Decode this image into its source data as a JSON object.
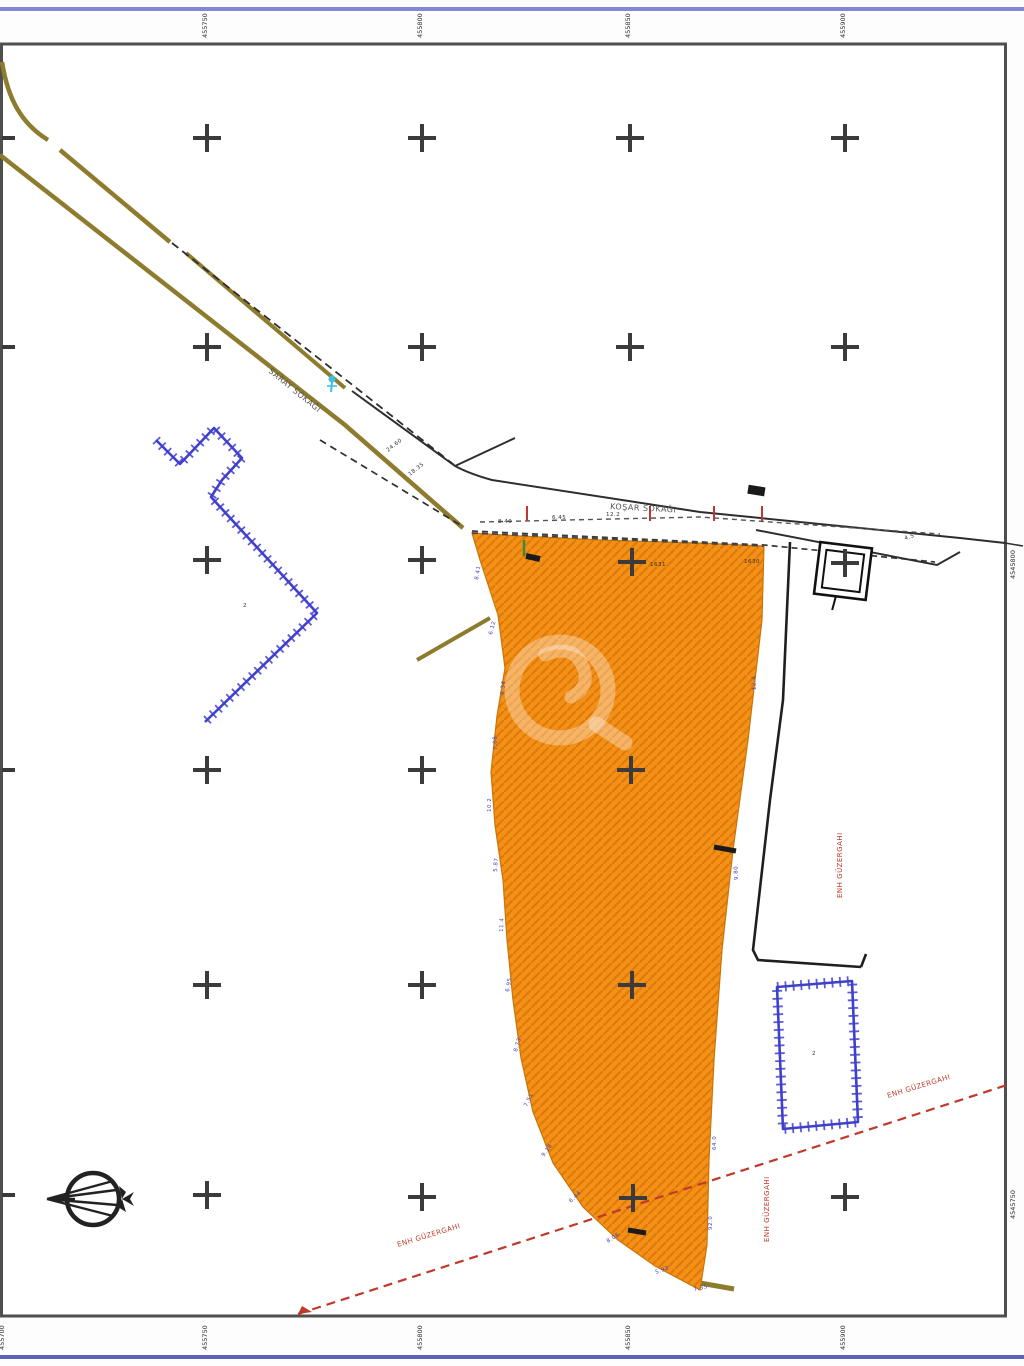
{
  "map": {
    "sheet": {
      "accent_top_color": "#8287d8",
      "accent_bottom_color": "#5b63c0",
      "frame_color": "#4f4f4f",
      "parcel_fill": "#f39018",
      "parcel_hatch": "#e07a06",
      "road_color": "#8d7b2e",
      "line_color": "#2e2e2e",
      "embankment_color": "#4040cc",
      "route_color": "#c0392b",
      "cross_color": "#3b3b3b",
      "marker_cyan": "#3fc0e0",
      "marker_green": "#3a8a3a"
    },
    "road_labels": [
      {
        "x": 268,
        "y": 372,
        "rot": 39,
        "text": "SARAY SOKAĞI"
      },
      {
        "x": 610,
        "y": 509,
        "rot": 3,
        "text": "KOŞAR SOKAĞI"
      }
    ],
    "red_labels": [
      {
        "x": 398,
        "y": 1247,
        "rot": -17,
        "text": "ENH GÜZERGAHI"
      },
      {
        "x": 888,
        "y": 1098,
        "rot": -17,
        "text": "ENH GÜZERGAHI"
      },
      {
        "x": 842,
        "y": 898,
        "rot": -90,
        "text": "ENH GÜZERGAHI"
      },
      {
        "x": 769,
        "y": 1242,
        "rot": -90,
        "text": "ENH GÜZERGAHI"
      }
    ],
    "grid_crosses": [
      [
        207,
        138
      ],
      [
        422,
        138
      ],
      [
        630,
        138
      ],
      [
        845,
        138
      ],
      [
        207,
        347
      ],
      [
        422,
        347
      ],
      [
        630,
        347
      ],
      [
        845,
        347
      ],
      [
        207,
        560
      ],
      [
        422,
        560
      ],
      [
        632,
        562
      ],
      [
        845,
        563
      ],
      [
        207,
        770
      ],
      [
        422,
        770
      ],
      [
        631,
        770
      ],
      [
        207,
        985
      ],
      [
        422,
        985
      ],
      [
        632,
        985
      ],
      [
        207,
        1195
      ],
      [
        422,
        1197
      ],
      [
        633,
        1198
      ],
      [
        845,
        1197
      ]
    ],
    "left_stubs": [
      138,
      347,
      770,
      1195
    ],
    "top_ticks": [
      {
        "x": 207,
        "text": "455750"
      },
      {
        "x": 422,
        "text": "455800"
      },
      {
        "x": 630,
        "text": "455850"
      },
      {
        "x": 845,
        "text": "455900"
      }
    ],
    "bottom_ticks": [
      {
        "x": 4,
        "text": "455700"
      },
      {
        "x": 207,
        "text": "455750"
      },
      {
        "x": 422,
        "text": "455800"
      },
      {
        "x": 630,
        "text": "455850"
      },
      {
        "x": 845,
        "text": "455900"
      }
    ],
    "right_ticks": [
      {
        "y": 557,
        "text": "4545800"
      },
      {
        "y": 1197,
        "text": "4545750"
      }
    ],
    "edge_measurements": [
      {
        "x": 478,
        "y": 580,
        "rot": -80,
        "text": "8.41"
      },
      {
        "x": 492,
        "y": 635,
        "rot": -75,
        "text": "6.12"
      },
      {
        "x": 504,
        "y": 695,
        "rot": -85,
        "text": "9.34"
      },
      {
        "x": 497,
        "y": 750,
        "rot": -92,
        "text": "7.08"
      },
      {
        "x": 491,
        "y": 812,
        "rot": -90,
        "text": "10.2"
      },
      {
        "x": 497,
        "y": 872,
        "rot": -86,
        "text": "5.87"
      },
      {
        "x": 503,
        "y": 932,
        "rot": -88,
        "text": "11.4"
      },
      {
        "x": 509,
        "y": 992,
        "rot": -80,
        "text": "6.95"
      },
      {
        "x": 517,
        "y": 1052,
        "rot": -74,
        "text": "8.73"
      },
      {
        "x": 527,
        "y": 1107,
        "rot": -64,
        "text": "7.51"
      },
      {
        "x": 544,
        "y": 1157,
        "rot": -54,
        "text": "9.18"
      },
      {
        "x": 571,
        "y": 1203,
        "rot": -44,
        "text": "6.44"
      },
      {
        "x": 608,
        "y": 1243,
        "rot": -33,
        "text": "8.06"
      },
      {
        "x": 656,
        "y": 1274,
        "rot": -20,
        "text": "5.92"
      },
      {
        "x": 694,
        "y": 1291,
        "rot": -12,
        "text": "7.35"
      },
      {
        "x": 756,
        "y": 690,
        "rot": -93,
        "text": "12.4"
      },
      {
        "x": 738,
        "y": 880,
        "rot": -92,
        "text": "9.80"
      },
      {
        "x": 716,
        "y": 1150,
        "rot": -90,
        "text": "64.0"
      },
      {
        "x": 712,
        "y": 1230,
        "rot": -90,
        "text": "92.0"
      }
    ],
    "tiny_dims": [
      {
        "x": 388,
        "y": 452,
        "rot": -38,
        "text": "24.60"
      },
      {
        "x": 410,
        "y": 476,
        "rot": -38,
        "text": "18.35"
      },
      {
        "x": 498,
        "y": 523,
        "rot": 0,
        "text": "8.40"
      },
      {
        "x": 552,
        "y": 519,
        "rot": 0,
        "text": "6.45"
      },
      {
        "x": 606,
        "y": 516,
        "rot": 0,
        "text": "12.2"
      },
      {
        "x": 650,
        "y": 566,
        "rot": 0,
        "text": "1631"
      },
      {
        "x": 744,
        "y": 563,
        "rot": 0,
        "text": "1630"
      },
      {
        "x": 812,
        "y": 1055,
        "rot": 0,
        "text": "2"
      },
      {
        "x": 243,
        "y": 607,
        "rot": 0,
        "text": "2"
      },
      {
        "x": 905,
        "y": 540,
        "rot": -18,
        "text": "4.5"
      }
    ],
    "red_ticks_x": [
      527,
      650,
      714,
      762
    ],
    "green_tick_x": 524
  }
}
